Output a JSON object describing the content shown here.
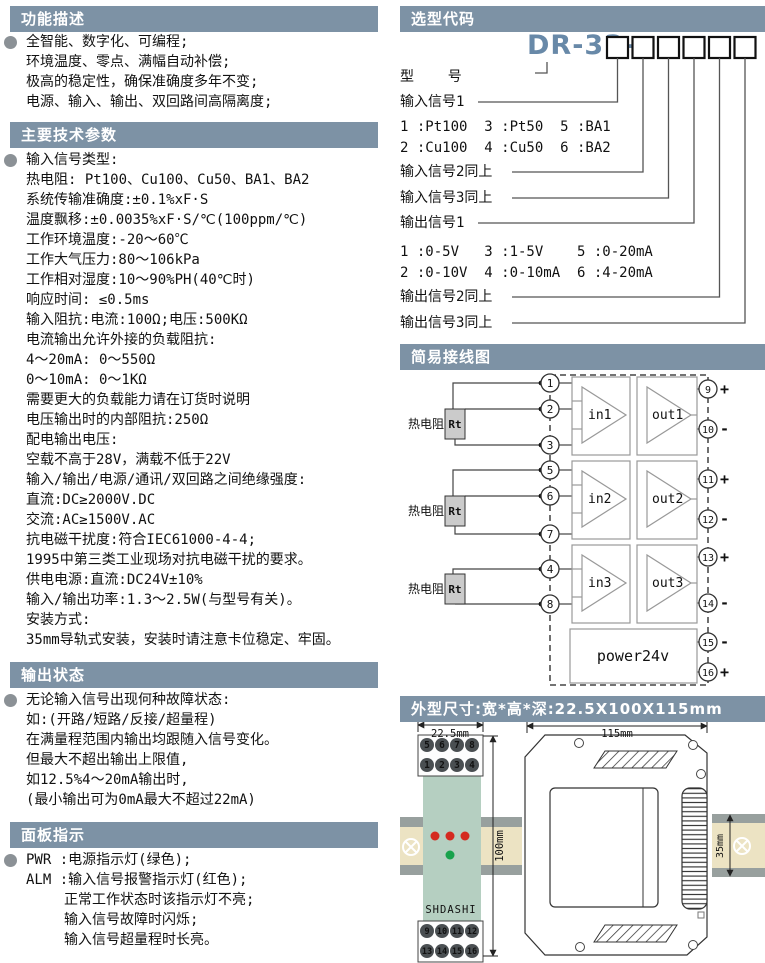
{
  "colors": {
    "header_bg": "#7d92a5",
    "model_blue": "#6889a8",
    "module_green": "#b5cfc1",
    "rail_beige": "#ece3c3",
    "rail_gray": "#98a09e",
    "led_red": "#d42a20",
    "led_green": "#18a24c",
    "terminal_dark": "#4a4f52"
  },
  "left": {
    "function": {
      "title": "功能描述",
      "lines": [
        "全智能、数字化、可编程;",
        "环境温度、零点、满幅自动补偿;",
        "极高的稳定性，确保准确度多年不变;",
        "电源、输入、输出、双回路间高隔离度;"
      ]
    },
    "params": {
      "title": "主要技术参数",
      "lines": [
        "输入信号类型:",
        "热电阻: Pt100、Cu100、Cu50、BA1、BA2",
        "系统传输准确度:±0.1%xF·S",
        "温度飘移:±0.0035%xF·S/℃(100ppm/℃)",
        "工作环境温度:-20～60℃",
        "工作大气压力:80～106kPa",
        "工作相对湿度:10～90%PH(40℃时)",
        "响应时间: ≤0.5ms",
        "输入阻抗:电流:100Ω;电压:500KΩ",
        "电流输出允许外接的负载阻抗:",
        "4～20mA: 0～550Ω",
        "0～10mA: 0～1KΩ",
        "需要更大的负载能力请在订货时说明",
        "电压输出时的内部阻抗:250Ω",
        "配电输出电压:",
        "空载不高于28V，满载不低于22V",
        "输入/输出/电源/通讯/双回路之间绝缘强度:",
        "直流:DC≥2000V.DC",
        "交流:AC≥1500V.AC",
        "抗电磁干扰度:符合IEC61000-4-4;",
        "1995中第三类工业现场对抗电磁干扰的要求。",
        "供电电源:直流:DC24V±10%",
        "输入/输出功率:1.3～2.5W(与型号有关)。",
        "安装方式:",
        "35mm导轨式安装，安装时请注意卡位稳定、牢固。"
      ]
    },
    "output_state": {
      "title": "输出状态",
      "lines": [
        "无论输入信号出现何种故障状态:",
        "如:(开路/短路/反接/超量程)",
        "在满量程范围内输出均跟随入信号变化。",
        "但最大不超出输出上限值,",
        "如12.5%4～20mA输出时,",
        "(最小输出可为0mA最大不超过22mA)"
      ]
    },
    "panel": {
      "title": "面板指示",
      "lines": [
        "PWR :电源指示灯(绿色);",
        "ALM :输入信号报警指示灯(红色);",
        "正常工作状态时该指示灯不亮;",
        "输入信号故障时闪烁;",
        "输入信号超量程时长亮。"
      ]
    }
  },
  "selection": {
    "title": "选型代码",
    "model_prefix": "DR-33-",
    "rows": [
      "型    号",
      "输入信号1",
      "1 :Pt100  3 :Pt50  5 :BA1",
      "2 :Cu100  4 :Cu50  6 :BA2",
      "输入信号2同上",
      "输入信号3同上",
      "输出信号1",
      "1 :0-5V   3 :1-5V    5 :0-20mA",
      "2 :0-10V  4 :0-10mA  6 :4-20mA",
      "输出信号2同上",
      "输出信号3同上"
    ]
  },
  "wiring": {
    "title": "简易接线图",
    "rtd_label": "热电阻",
    "rt_label": "Rt",
    "amp_in": [
      "in1",
      "in2",
      "in3"
    ],
    "amp_out": [
      "out1",
      "out2",
      "out3"
    ],
    "power_label": "power24v",
    "left_terminals": [
      "1",
      "2",
      "3",
      "5",
      "6",
      "7",
      "4",
      "8"
    ],
    "right_terminals": [
      "9",
      "10",
      "11",
      "12",
      "13",
      "14",
      "15",
      "16"
    ],
    "right_signs": [
      "+",
      "-",
      "+",
      "-",
      "+",
      "-",
      "-",
      "+"
    ]
  },
  "dimensions": {
    "title": "外型尺寸:宽*高*深:22.5X100X115mm",
    "front_width": "22.5mm",
    "front_height": "100mm",
    "brand": "SHDASHI",
    "side_width": "115mm",
    "rail_height": "35mm",
    "front_terminals": {
      "top1": [
        "5",
        "6",
        "7",
        "8"
      ],
      "top2": [
        "1",
        "2",
        "3",
        "4"
      ],
      "bot1": [
        "9",
        "10",
        "11",
        "12"
      ],
      "bot2": [
        "13",
        "14",
        "15",
        "16"
      ]
    }
  }
}
